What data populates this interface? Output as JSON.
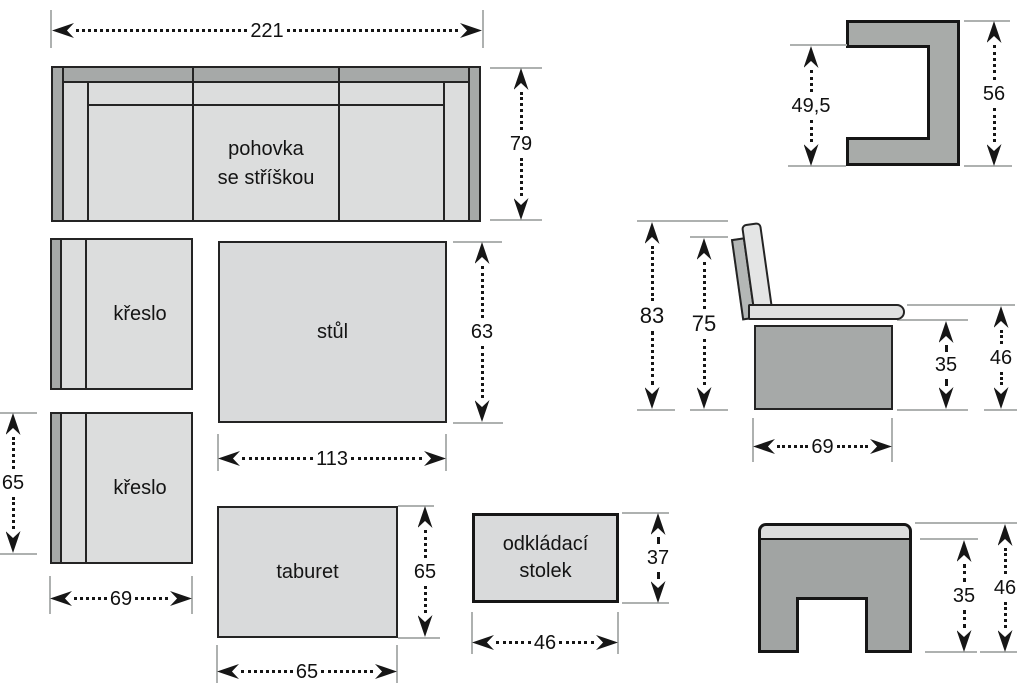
{
  "colors": {
    "background": "#ffffff",
    "outline": "#242424",
    "fill_light": "#dcdddd",
    "fill_mid": "#a6a9a8",
    "fill_cushion": "#e4e5e5",
    "extension_line": "#aeb1b0",
    "dimension_ink": "#161616"
  },
  "sofa": {
    "label_line1": "pohovka",
    "label_line2": "se stříškou",
    "width": "221",
    "depth": "79"
  },
  "armchair_top": {
    "label": "křeslo"
  },
  "armchair_bottom": {
    "label": "křeslo",
    "depth": "65",
    "width": "69"
  },
  "table": {
    "label": "stůl",
    "depth": "63",
    "width": "113"
  },
  "tabouret": {
    "label": "taburet",
    "depth": "65",
    "width": "65"
  },
  "side_table": {
    "label_line1": "odkládací",
    "label_line2": "stolek",
    "depth": "37",
    "width": "46"
  },
  "canopy_profile": {
    "inner_height": "49,5",
    "outer_height": "56"
  },
  "bench_profile": {
    "total_height": "83",
    "backrest_height": "75",
    "base_height": "35",
    "seat_height": "46",
    "depth": "69"
  },
  "stool_profile": {
    "base_height": "35",
    "total_height": "46"
  }
}
